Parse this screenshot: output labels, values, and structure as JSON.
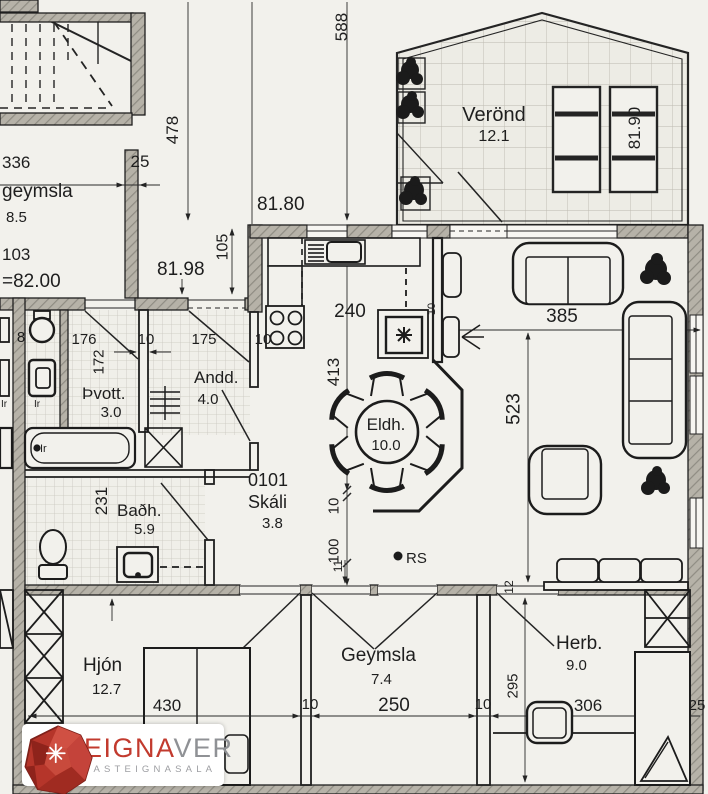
{
  "rooms": {
    "verond": {
      "name": "Verönd",
      "area": "12.1"
    },
    "upper_geymsla": {
      "name": "geymsla",
      "area": "8.5",
      "code": "103",
      "level": "=82.00"
    },
    "thvott": {
      "name": "Þvott.",
      "area": "3.0"
    },
    "andd": {
      "name": "Andd.",
      "area": "4.0"
    },
    "eldh": {
      "name": "Eldh.",
      "area": "10.0"
    },
    "stofa": {
      "name": "Stofa",
      "area": "20.5"
    },
    "badh": {
      "name": "Baðh.",
      "area": "5.9"
    },
    "skali": {
      "unit": "0101",
      "name": "Skáli",
      "area": "3.8"
    },
    "hjon": {
      "name": "Hjón",
      "area": "12.7"
    },
    "geymsla": {
      "name": "Geymsla",
      "area": "7.4"
    },
    "herb": {
      "name": "Herb.",
      "area": "9.0"
    }
  },
  "levels": {
    "outside_top": "81.80",
    "entry": "81.98",
    "verond": "81.90"
  },
  "dims": {
    "d588": "588",
    "d478": "478",
    "d336": "336",
    "d25_top": "25",
    "d105": "105",
    "d240": "240",
    "d176": "176",
    "d10_hall": "10",
    "d175": "175",
    "d10_kitchen": "10",
    "d172": "172",
    "d8": "8",
    "d413": "413",
    "d385": "385",
    "d523": "523",
    "d100": "100",
    "d10_skali": "10",
    "d231": "231",
    "d430": "430",
    "d10_left": "10",
    "d250": "250",
    "d10_right": "10",
    "d295": "295",
    "d306": "306",
    "d25_right": "25",
    "d11": "11",
    "d12": "12",
    "d10_fridge": "10"
  },
  "markers": {
    "rs": "RS",
    "ir_a": "Ir",
    "ir_b": "Ir",
    "ir_c": "Ir"
  },
  "logo": {
    "word_primary": "EIGNA",
    "word_secondary": "VER",
    "tagline": "FASTEIGNASALA",
    "accent_color": "#c23a2e"
  }
}
